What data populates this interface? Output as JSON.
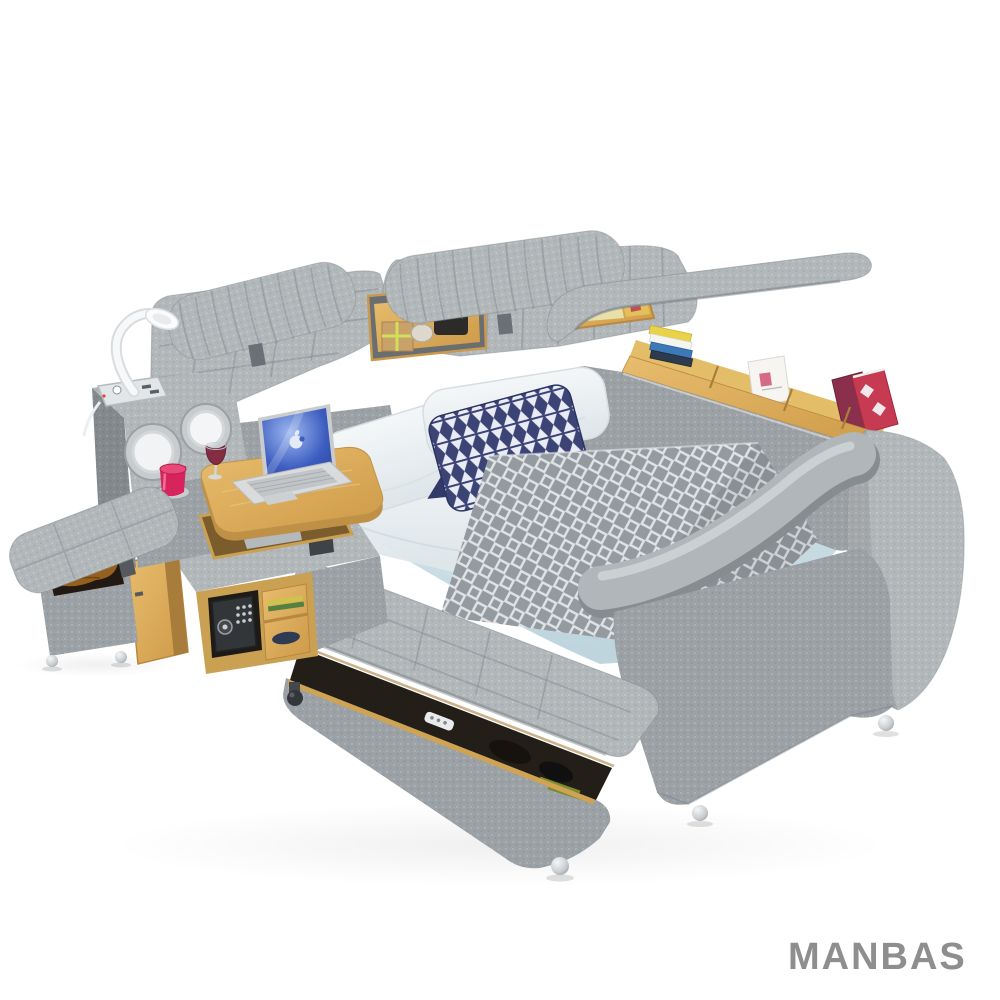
{
  "meta": {
    "type": "product-photo",
    "background": "#ffffff",
    "subject": "Multifunctional smart bed with tufted gray upholstery, built-in speakers, USB power outlets, reading lamp, swivel laptop desk, digital safe, bookshelf rail and flip-open storage ottomans"
  },
  "brand": {
    "logo_text": "MANBAS",
    "logo": "#8e8e8e"
  },
  "palette": {
    "fabric_light": "#b2b7ba",
    "fabric_mid": "#9ba1a5",
    "fabric_dark": "#83898d",
    "wood": "#d9a855",
    "wood_dark": "#b9883f",
    "sheet_blue": "#c9dbe2",
    "pillow_white": "#edf1f4",
    "navy": "#3c4476",
    "runner_gray": "#939aa0",
    "laptop_screen": "#3c5cc0",
    "safe_black": "#323639",
    "cup_red": "#d8245e",
    "chrome": "#c9cdd0",
    "logo": "#8e8e8e"
  },
  "objects": [
    "headboard with adjustable headrests",
    "wooden storage niche with gift box, glass jar and black case",
    "flip-up right armrest",
    "bookshelf rail with books and magazines",
    "stereo speaker console",
    "USB power outlet panel",
    "white gooseneck reading lamp",
    "swivel wooden laptop desk",
    "silver laptop with blue screen",
    "cup holder with red cup and wine glass",
    "navy triangle-pattern throw pillow",
    "two white pillows",
    "light blue fitted sheet",
    "gray diamond-weave runner blanket",
    "footboard storage bench with open lid",
    "storage ottoman stool with blanket",
    "digital safe behind open wooden door",
    "side shelves with books",
    "chrome ball feet"
  ]
}
